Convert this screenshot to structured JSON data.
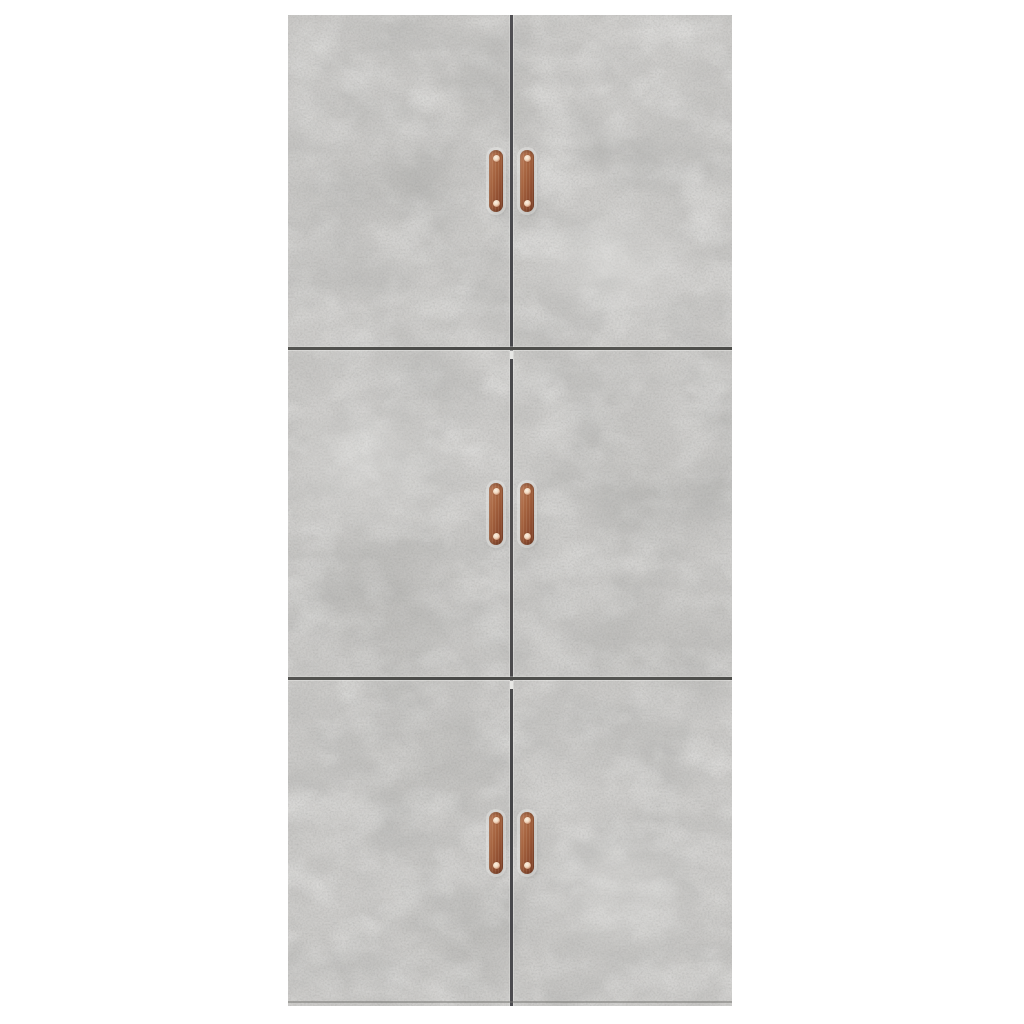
{
  "scene": {
    "type": "product-photo",
    "background_color": "#ffffff",
    "subject": "Tall cabinet in concrete grey with six doors and copper-coloured strap handles",
    "label": "Concrete grey cabinet product photo"
  },
  "cabinet": {
    "finish": "concrete grey",
    "base_color": "#cdccca",
    "seam_color": "#4b4b4f",
    "rows": 3,
    "columns": 2,
    "door_count": 6,
    "label": "Six-door concrete grey cabinet",
    "doors": [
      {
        "id": "top-left",
        "label": "Top left door"
      },
      {
        "id": "top-right",
        "label": "Top right door"
      },
      {
        "id": "middle-left",
        "label": "Middle left door"
      },
      {
        "id": "middle-right",
        "label": "Middle right door"
      },
      {
        "id": "bottom-left",
        "label": "Bottom left door"
      },
      {
        "id": "bottom-right",
        "label": "Bottom right door"
      }
    ],
    "handles": {
      "count": 6,
      "style": "vertical leather strap pull with two rivets",
      "color": "#a05c3c",
      "highlight_color": "#bd7e5c",
      "shadow_color": "#7d4128",
      "rivet_color": "#f3e2d2",
      "label": "Copper strap handle"
    }
  }
}
